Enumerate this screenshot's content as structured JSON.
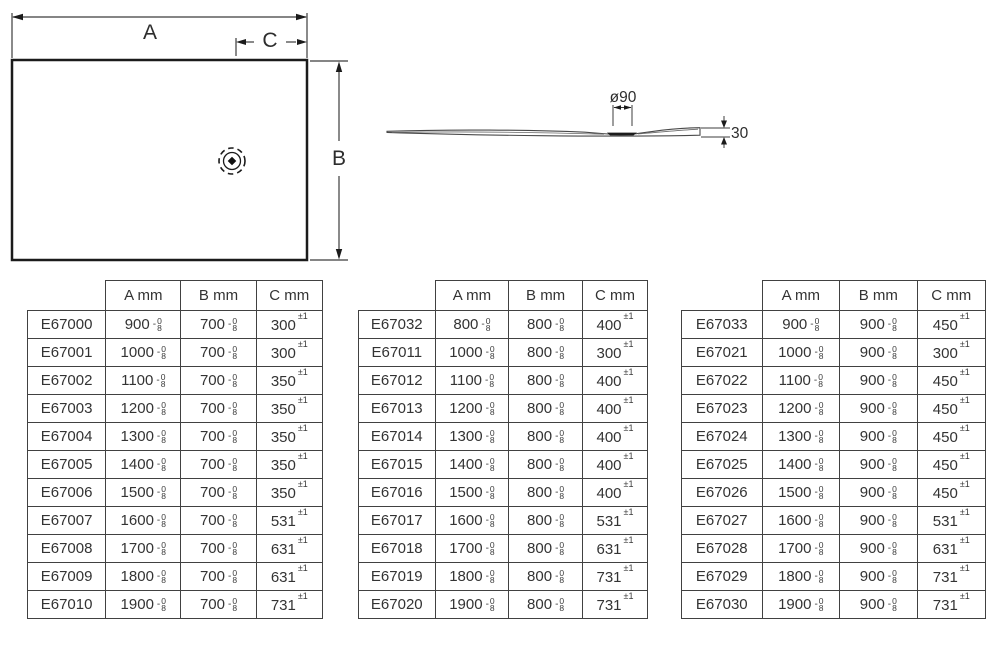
{
  "diagram": {
    "plan": {
      "label_a": "A",
      "label_b": "B",
      "label_c": "C"
    },
    "side": {
      "label_diameter": "ø90",
      "label_height": "30"
    }
  },
  "tolerances": {
    "ab_sign": "-",
    "ab_top": "0",
    "ab_bottom": "8",
    "c": "±1"
  },
  "tables": [
    {
      "headers": [
        "",
        "A mm",
        "B mm",
        "C mm"
      ],
      "rows": [
        [
          "E67000",
          "900",
          "700",
          "300"
        ],
        [
          "E67001",
          "1000",
          "700",
          "300"
        ],
        [
          "E67002",
          "1100",
          "700",
          "350"
        ],
        [
          "E67003",
          "1200",
          "700",
          "350"
        ],
        [
          "E67004",
          "1300",
          "700",
          "350"
        ],
        [
          "E67005",
          "1400",
          "700",
          "350"
        ],
        [
          "E67006",
          "1500",
          "700",
          "350"
        ],
        [
          "E67007",
          "1600",
          "700",
          "531"
        ],
        [
          "E67008",
          "1700",
          "700",
          "631"
        ],
        [
          "E67009",
          "1800",
          "700",
          "631"
        ],
        [
          "E67010",
          "1900",
          "700",
          "731"
        ]
      ]
    },
    {
      "headers": [
        "",
        "A mm",
        "B mm",
        "C mm"
      ],
      "rows": [
        [
          "E67032",
          "800",
          "800",
          "400"
        ],
        [
          "E67011",
          "1000",
          "800",
          "300"
        ],
        [
          "E67012",
          "1100",
          "800",
          "400"
        ],
        [
          "E67013",
          "1200",
          "800",
          "400"
        ],
        [
          "E67014",
          "1300",
          "800",
          "400"
        ],
        [
          "E67015",
          "1400",
          "800",
          "400"
        ],
        [
          "E67016",
          "1500",
          "800",
          "400"
        ],
        [
          "E67017",
          "1600",
          "800",
          "531"
        ],
        [
          "E67018",
          "1700",
          "800",
          "631"
        ],
        [
          "E67019",
          "1800",
          "800",
          "731"
        ],
        [
          "E67020",
          "1900",
          "800",
          "731"
        ]
      ]
    },
    {
      "headers": [
        "",
        "A mm",
        "B mm",
        "C mm"
      ],
      "rows": [
        [
          "E67033",
          "900",
          "900",
          "450"
        ],
        [
          "E67021",
          "1000",
          "900",
          "300"
        ],
        [
          "E67022",
          "1100",
          "900",
          "450"
        ],
        [
          "E67023",
          "1200",
          "900",
          "450"
        ],
        [
          "E67024",
          "1300",
          "900",
          "450"
        ],
        [
          "E67025",
          "1400",
          "900",
          "450"
        ],
        [
          "E67026",
          "1500",
          "900",
          "450"
        ],
        [
          "E67027",
          "1600",
          "900",
          "531"
        ],
        [
          "E67028",
          "1700",
          "900",
          "631"
        ],
        [
          "E67029",
          "1800",
          "900",
          "731"
        ],
        [
          "E67030",
          "1900",
          "900",
          "731"
        ]
      ]
    }
  ]
}
